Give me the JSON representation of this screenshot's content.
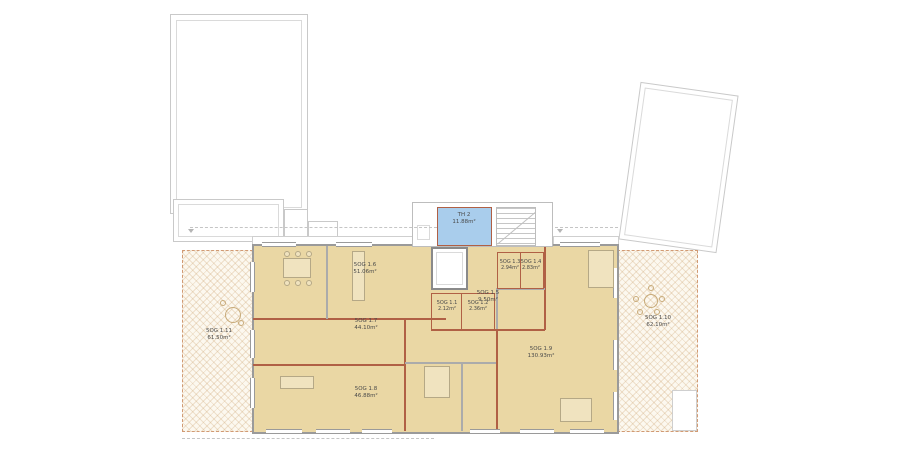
{
  "rooms": {
    "th2": {
      "label": "TH 2",
      "area": "11.88m²"
    },
    "r1_1": {
      "label": "5OG 1.1",
      "area": "2.12m²"
    },
    "r1_2": {
      "label": "5OG 1.2",
      "area": "2.36m²"
    },
    "r1_3": {
      "label": "5OG 1.3",
      "area": "2.94m²"
    },
    "r1_4": {
      "label": "5OG 1.4",
      "area": "2.83m²"
    },
    "r1_5": {
      "label": "5OG 1.5",
      "area": "9.50m²"
    },
    "r1_6": {
      "label": "5OG 1.6",
      "area": "51.06m²"
    },
    "r1_7": {
      "label": "5OG 1.7",
      "area": "44.10m²"
    },
    "r1_8": {
      "label": "5OG 1.8",
      "area": "46.88m²"
    },
    "r1_9": {
      "label": "5OG 1.9",
      "area": "130.93m²"
    },
    "r1_10": {
      "label": "5OG 1.10",
      "area": "62.10m²"
    },
    "r1_11": {
      "label": "5OG 1.11",
      "area": "61.50m²"
    }
  },
  "colors": {
    "room-fill": "#ead7a4",
    "terrace-bg": "#fcf8ef",
    "stair-blue": "#a9cdec",
    "wall-accent": "#b06045",
    "outline-gray": "#9a9a9a"
  }
}
